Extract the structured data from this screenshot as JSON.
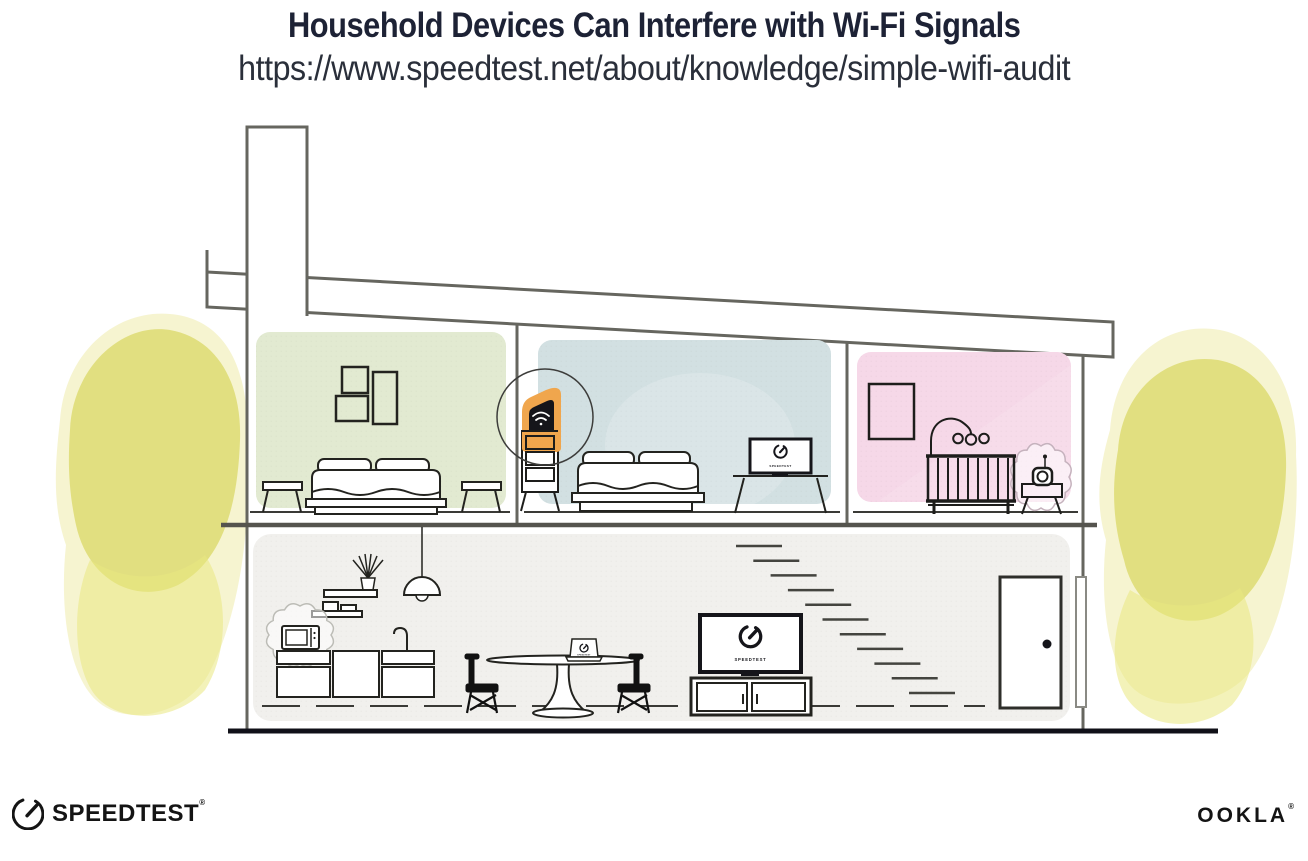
{
  "header": {
    "title": "Household Devices Can Interfere with Wi-Fi Signals",
    "url": "https://www.speedtest.net/about/knowledge/simple-wifi-audit"
  },
  "branding": {
    "speedtest_wordmark": "SPEEDTEST",
    "speedtest_reg_mark": "®",
    "ookla_wordmark": "OOKLA",
    "ookla_reg_mark": "®"
  },
  "illustration": {
    "device_screen_label": "SPEEDTEST",
    "highlighted_device": "wi-fi-router",
    "interference_sources": [
      "microwave-oven",
      "baby-monitor"
    ],
    "rooms": [
      {
        "id": "bedroom-left",
        "fill": "#e2ead1"
      },
      {
        "id": "bedroom-middle",
        "fill": "#d2e0e2"
      },
      {
        "id": "nursery-right",
        "fill": "#f6d8e8"
      },
      {
        "id": "ground-floor",
        "fill": "#f1f0ed"
      }
    ],
    "colors": {
      "router_highlight_orange": "#f0a64d",
      "foliage_yellow": "#dcd96c",
      "structure_gray": "#66665f",
      "ink": "#1d1d1b"
    }
  }
}
